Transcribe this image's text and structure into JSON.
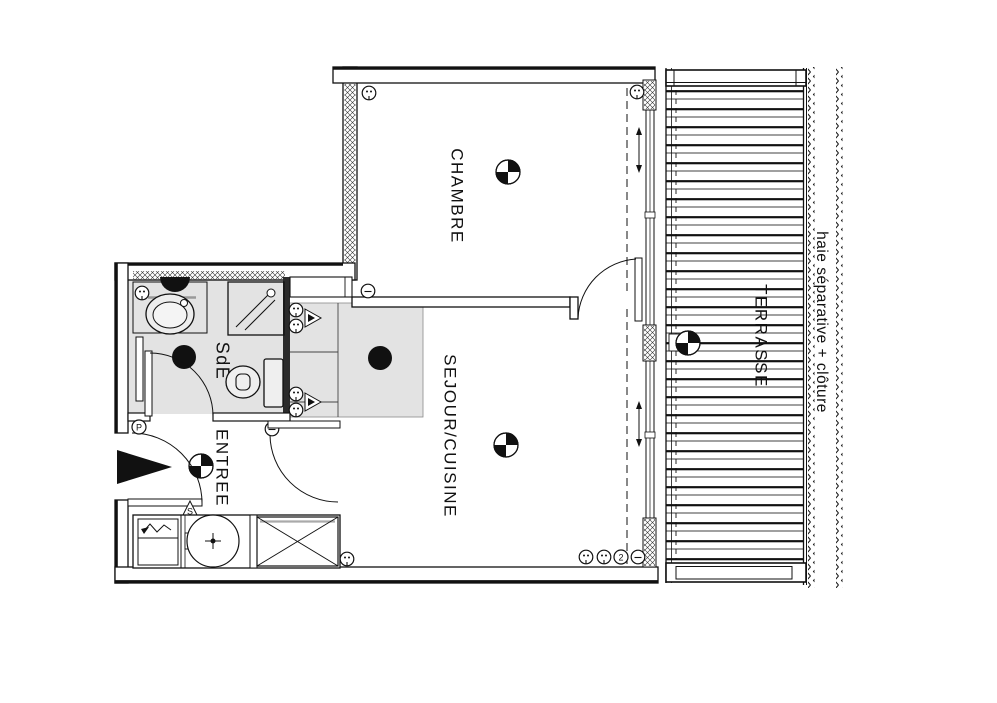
{
  "plan": {
    "rooms": [
      {
        "id": "chambre",
        "label": "CHAMBRE"
      },
      {
        "id": "sde",
        "label": "SdE"
      },
      {
        "id": "entree",
        "label": "ENTREE"
      },
      {
        "id": "sejour-cuisine",
        "label": "SEJOUR/CUISINE"
      },
      {
        "id": "terrasse",
        "label": "TERRASSE"
      }
    ],
    "annotations": {
      "hedge": "haie séparative + clôture"
    },
    "symbols": {
      "threshold": "S",
      "switch_p": "P",
      "tv_outlet": "2"
    },
    "colors": {
      "line": "#111111",
      "room_fill": "#e3e3e3",
      "paper": "#ffffff"
    }
  }
}
